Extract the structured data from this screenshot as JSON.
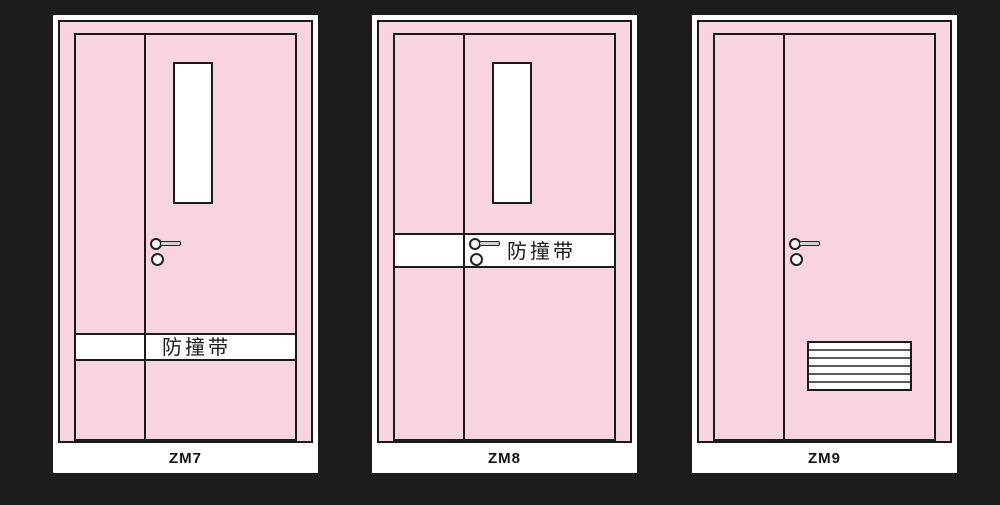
{
  "background_color": "#1d1b1b",
  "palette": {
    "door_pink": "#f8d3e2",
    "outline_black": "#1a1a1a",
    "card_white": "#ffffff",
    "hardware_gray": "#cfcfcf",
    "louver_line_gray": "#5a5a5a"
  },
  "doors": [
    {
      "label": "ZM7",
      "band_label": "防撞带",
      "has_window": true,
      "has_band": true,
      "band_position": "lower",
      "has_louver": false
    },
    {
      "label": "ZM8",
      "band_label": "防撞带",
      "has_window": true,
      "has_band": true,
      "band_position": "middle-at-handle",
      "has_louver": false
    },
    {
      "label": "ZM9",
      "has_window": false,
      "has_band": false,
      "has_louver": true
    }
  ]
}
